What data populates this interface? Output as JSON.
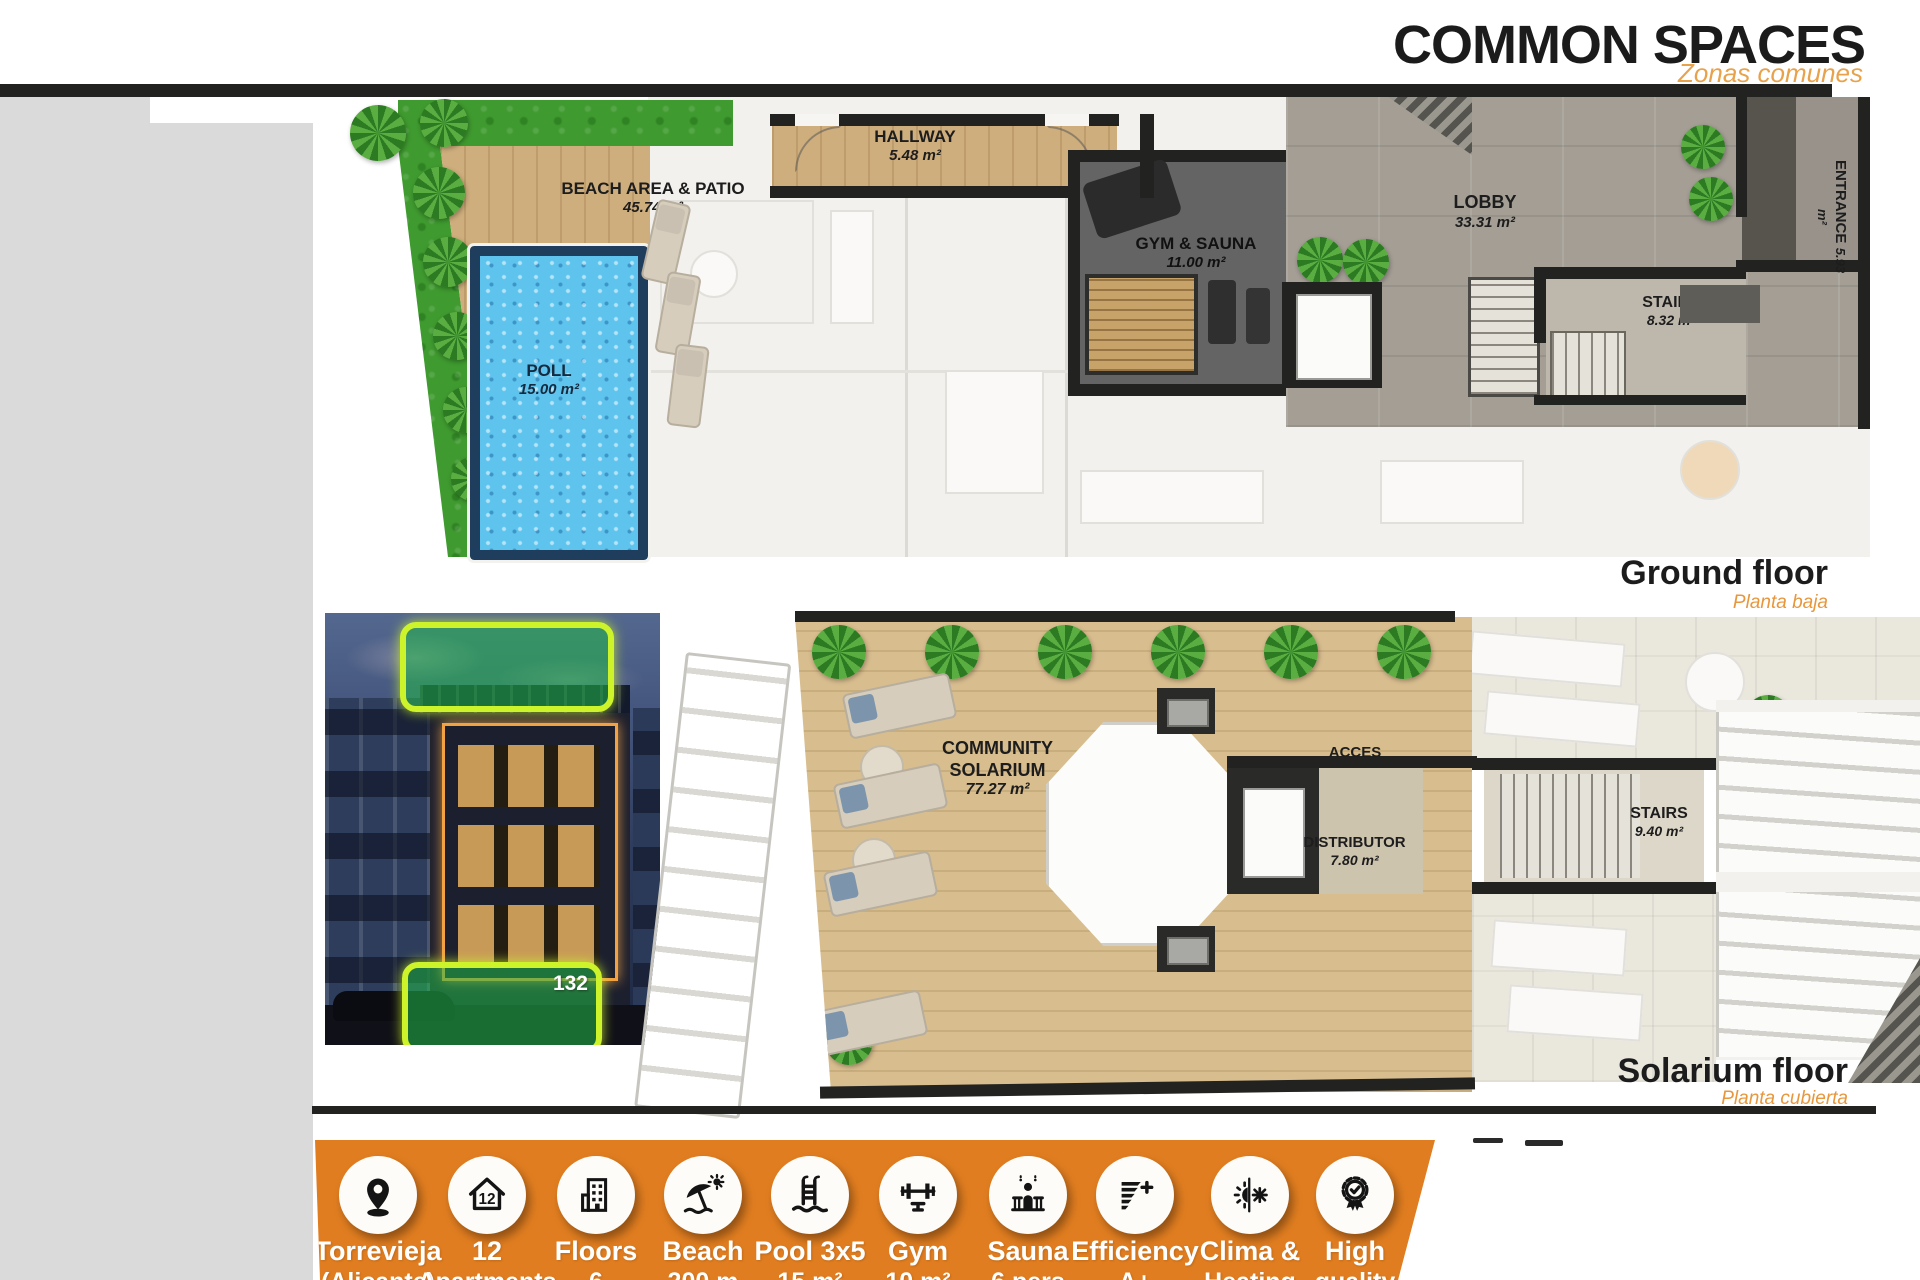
{
  "header": {
    "title": "COMMON SPACES",
    "subtitle": "Zonas comunes"
  },
  "ground_floor": {
    "label": "Ground floor",
    "label_es": "Planta baja",
    "rooms": [
      {
        "name": "BEACH AREA & PATIO",
        "area": "45.74 m²"
      },
      {
        "name": "POLL",
        "area": "15.00 m²"
      },
      {
        "name": "HALLWAY",
        "area": "5.48 m²"
      },
      {
        "name": "GYM & SAUNA",
        "area": "11.00 m²"
      },
      {
        "name": "LOBBY",
        "area": "33.31 m²"
      },
      {
        "name": "STAIRS",
        "area": "8.32 m²"
      },
      {
        "name": "ENTRANCE",
        "area": "5.93 m²"
      }
    ]
  },
  "solarium_floor": {
    "label": "Solarium floor",
    "label_es": "Planta cubierta",
    "rooms": [
      {
        "name": "COMMUNITY SOLARIUM",
        "area": "77.27 m²"
      },
      {
        "name": "ACCES",
        "area": ""
      },
      {
        "name": "DISTRIBUTOR",
        "area": "7.80 m²"
      },
      {
        "name": "STAIRS",
        "area": "9.40 m²"
      }
    ]
  },
  "photo": {
    "badge": "132"
  },
  "features": [
    {
      "icon": "location-pin",
      "line1": "Torrevieja",
      "line2": "(Alicante)"
    },
    {
      "icon": "house-12",
      "line1": "12",
      "line2": "Apartments"
    },
    {
      "icon": "building-floors",
      "line1": "Floors",
      "line2": "6"
    },
    {
      "icon": "beach-umbrella",
      "line1": "Beach",
      "line2": "200 m"
    },
    {
      "icon": "pool-ladder",
      "line1": "Pool 3x5",
      "line2": "15 m²"
    },
    {
      "icon": "gym-barbell",
      "line1": "Gym",
      "line2": "10 m²"
    },
    {
      "icon": "sauna-person",
      "line1": "Sauna",
      "line2": "6 pers"
    },
    {
      "icon": "efficiency-chart",
      "line1": "Efficiency",
      "line2": "A+"
    },
    {
      "icon": "climate-sun-snowflake",
      "line1": "Clima &",
      "line2": "Heating"
    },
    {
      "icon": "quality-medal",
      "line1": "High",
      "line2": "quality"
    }
  ],
  "colors": {
    "accent_orange": "#e07d20",
    "subtitle_orange": "#e8a24b",
    "bar_black": "#1c1c1c",
    "grass_green": "#3f9b2f",
    "pool_blue": "#59c2ec",
    "wood": "#d2b284",
    "highlight_green": "#23b948"
  }
}
